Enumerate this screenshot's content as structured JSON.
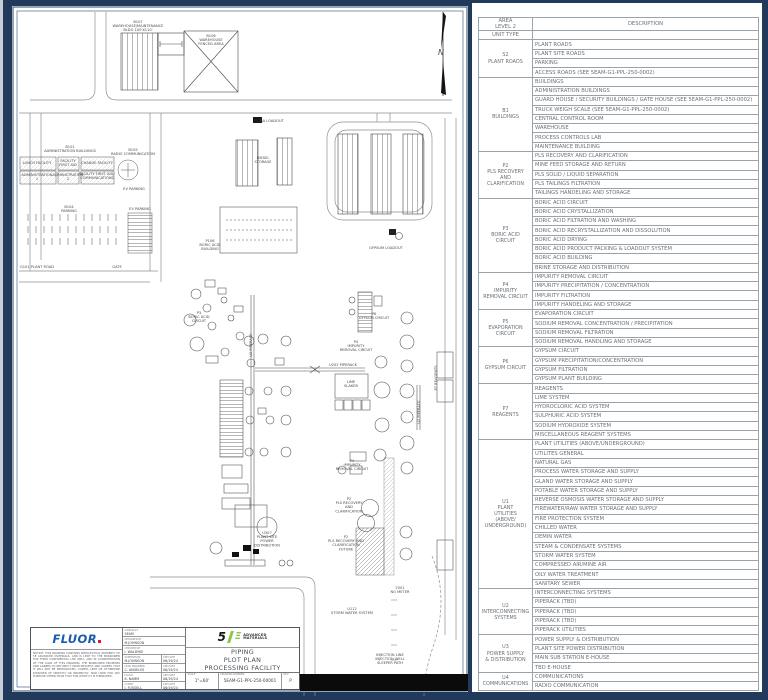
{
  "drawing": {
    "north_label": "N",
    "labels": [
      {
        "x": 138,
        "y": 23,
        "text": "B107\nWAREHOUSE/MAINTENANCE\nBLDG 100'X110'"
      },
      {
        "x": 211,
        "y": 37,
        "text": "B106\nWAREHOUSE\nFENCED AREA"
      },
      {
        "x": 272,
        "y": 122,
        "text": "BA LOADOUT"
      },
      {
        "x": 70,
        "y": 148,
        "text": "B101\nADMINISTRATION BUILDINGS"
      },
      {
        "x": 133,
        "y": 151,
        "text": "B105\nRADIO COMMUNICATION"
      },
      {
        "x": 37,
        "y": 164,
        "text": "LUNCH FACILITY"
      },
      {
        "x": 68,
        "y": 162,
        "text": "FACILITY\nFIRST AID"
      },
      {
        "x": 97,
        "y": 164,
        "text": "CHANGE FACILITY"
      },
      {
        "x": 37,
        "y": 176,
        "text": "ADMINISTRATION\n1"
      },
      {
        "x": 68,
        "y": 176,
        "text": "ADMINISTRATION\n2"
      },
      {
        "x": 97,
        "y": 175,
        "text": "FACILITY FIRST AID/\nCOMMUNICATIONS"
      },
      {
        "x": 134,
        "y": 190,
        "text": "EV PARKING"
      },
      {
        "x": 69,
        "y": 208,
        "text": "B104\nPARKING"
      },
      {
        "x": 140,
        "y": 210,
        "text": "EV PARKING"
      },
      {
        "x": 37,
        "y": 268,
        "text": "G101 PLANT ROAD"
      },
      {
        "x": 117,
        "y": 268,
        "text": "GATE"
      },
      {
        "x": 263,
        "y": 159,
        "text": "DIESEL\nSTORAGE"
      },
      {
        "x": 210,
        "y": 242,
        "text": "P106\nBORIC ACID\nBUILDING"
      },
      {
        "x": 386,
        "y": 249,
        "text": "GYPSUM LOADOUT"
      },
      {
        "x": 199,
        "y": 314,
        "text": "P3\nBORIC ACID\nCIRCUIT"
      },
      {
        "x": 374,
        "y": 315,
        "text": "P6\nGYPSUM CIRCUIT"
      },
      {
        "x": 356,
        "y": 343,
        "text": "P4\nIMPURITY\nREMOVAL CIRCUIT"
      },
      {
        "x": 343,
        "y": 366,
        "text": "U202 PIPERACK"
      },
      {
        "x": 351,
        "y": 383,
        "text": "LIME\nSLAKER"
      },
      {
        "x": 437,
        "y": 378,
        "text": "P7 REAGENTS",
        "vertical": true
      },
      {
        "x": 252,
        "y": 345,
        "text": "U2 PIPERACK",
        "vertical": true
      },
      {
        "x": 420,
        "y": 412,
        "text": "U2 PIPERACK",
        "vertical": true
      },
      {
        "x": 267,
        "y": 534,
        "text": "U307\nPLANT SITE\nPOWER\nDISTRIBUTION"
      },
      {
        "x": 352,
        "y": 462,
        "text": "P4\nIMPURITY\nREMOVAL CIRCUIT"
      },
      {
        "x": 349,
        "y": 500,
        "text": "P2\nPLS RECOVERY\nAND\nCLARIFICATION"
      },
      {
        "x": 346,
        "y": 538,
        "text": "P2\nPLS RECOVERY AND\nCLARIFICATION\nFUTURE"
      },
      {
        "x": 352,
        "y": 610,
        "text": "U112\nSTORM WATER SYSTEM"
      },
      {
        "x": 400,
        "y": 589,
        "text": "2501\nNO METER"
      },
      {
        "x": 390,
        "y": 656,
        "text": "INJECTION LINE\nINJECTION WELL\nSLEEPER PATH"
      }
    ]
  },
  "title_block": {
    "fluor_logo": "FLUOR",
    "notice": "NOTICE: THIS DRAWING CONTAINS INTELLECTUAL PROPERTY OF 5E ADVANCED MATERIALS, AND IS LENT TO THE BORROWER FOR THEIR CONFIDENTIAL USE ONLY, AND IN CONSIDERATION OF THE LOAN OF THIS DRAWING, THE BORROWER PROMISES AND AGREES TO RETURN IT UPON REQUEST AND AGREES THAT IT WILL NOT BE REPRODUCED, COPIED, LENT OR OTHERWISE DISPOSED OF DIRECTLY OR INDIRECTLY, NOR USED FOR ANY PURPOSE OTHER THAN THAT FOR WHICH IT IS FURNISHED.",
    "app_date_label": "APP DATE",
    "approvals": [
      {
        "role": "CONTRACT",
        "name": "5EAM",
        "date": ""
      },
      {
        "role": "DESIGNED BY",
        "name": "M.JOHNSON",
        "date": ""
      },
      {
        "role": "CHECKED BY",
        "name": "J. WALDYKE",
        "date": ""
      },
      {
        "role": "SUPERVISOR",
        "name": "M.JOHNSON",
        "date": "06/19/24"
      },
      {
        "role": "LEAD ENGINEER",
        "name": "C. ANGELES",
        "date": "06/19/24"
      },
      {
        "role": "FLUOR",
        "name": "K. NAMM",
        "date": "06/19/24"
      },
      {
        "role": "CLIENT",
        "name": "J. FUSSELL",
        "date": "06/19/24"
      }
    ],
    "logo_line1": "ADVANCED",
    "logo_line2": "MATERIALS",
    "title_line1": "PIPING",
    "title_line2": "PLOT PLAN",
    "title_line3": "PROCESSING FACILITY",
    "scale_label": "SCALE",
    "scale_value": "1\"=60'",
    "drawing_number_label": "DRAWING NUMBER",
    "drawing_number": "5EAM-G1-PPL-250-00001",
    "rev_label": "REV",
    "rev_value": "P"
  },
  "legend_table": {
    "header": {
      "area_line1": "AREA",
      "area_line2": "LEVEL 2",
      "unit_type": "UNIT TYPE",
      "description": "DESCRIPTION"
    },
    "groups": [
      {
        "unit": "S2\nPLANT ROADS",
        "rows": [
          "PLANT ROADS",
          "PLANT SITE ROADS",
          "PARKING",
          "ACCESS ROADS (SEE 5EAM-G1-PPL-250-0002)"
        ]
      },
      {
        "unit": "B1\nBUILDINGS",
        "rows": [
          "BUILDINGS",
          "ADMINISTRATION BUILDINGS",
          "GUARD HOUSE / SECURITY BUILDINGS / GATE HOUSE (SEE 5EAM-G1-PPL-250-0002)",
          "TRUCK WEIGH SCALE (SEE 5EAM-G1-PPL-250-0002)",
          "CENTRAL CONTROL ROOM",
          "WAREHOUSE",
          "PROCESS CONTROLS LAB",
          "MAINTENANCE BUILDING"
        ]
      },
      {
        "unit": "P2\nPLS RECOVERY\nAND\nCLARIFICATION",
        "rows": [
          "PLS RECOVERY AND CLARIFICATION",
          "MINE FEED STORAGE AND RETURN",
          "PLS SOLID / LIQUID SEPARATION",
          "PLS TAILINGS FILTRATION",
          "TAILINGS HANDELING AND STORAGE"
        ]
      },
      {
        "unit": "P3\nBORIC ACID\nCIRCUIT",
        "rows": [
          "BORIC ACID CIRCUIT",
          "BORIC ACID CRYSTALLIZATION",
          "BORIC ACID FILTRATION AND WASHING",
          "BORIC ACID RECRYSTALLIZATION AND DISSOLUTION",
          "BORIC ACID DRYING",
          "BORIC ACID PRODUCT PACKING & LOADOUT SYSTEM",
          "BORIC ACID BUILDING",
          "BRINE STORAGE AND DISTRIBUTION"
        ]
      },
      {
        "unit": "P4\nIMPURITY\nREMOVAL CIRCUIT",
        "rows": [
          "IMPURITY REMOVAL CIRCUIT",
          "IMPURITY PRECIPITATION / CONCENTRATION",
          "IMPURITY FILTRATION",
          "IMPURITY HANDELING AND STORAGE"
        ]
      },
      {
        "unit": "P5\nEVAPORATION\nCIRCUIT",
        "rows": [
          "EVAPORATION CIRCUIT",
          "SODIUM REMOVAL CONCENTRATION / PRECIPITATION",
          "SODIUM REMOVAL FILTRATION",
          "SODIUM REMOVAL HANDLING AND STORAGE"
        ]
      },
      {
        "unit": "P6\nGYPSUM CIRCUIT",
        "rows": [
          "GYPSUM CIRCUIT",
          "GYPSUM PRECIPITATION/CONCENTRATION",
          "GYPSUM FILTRATION",
          "GYPSUM PLANT BUILDING"
        ]
      },
      {
        "unit": "P7\nREAGENTS",
        "rows": [
          "REAGENTS",
          "LIME SYSTEM",
          "HYDROCLORIC ACID SYSTEM",
          "SULPHURIC ACID SYSTEM",
          "SODIUM HYDROXIDE SYSTEM",
          "MISCELLANEOUS REAGENT SYSTEMS"
        ]
      },
      {
        "unit": "U1\nPLANT\nUTILITIES\n(ABOVE/\nUNDERGROUND)",
        "rows": [
          "PLANT UTILITIES (ABOVE/UNDERGROUND)",
          "UTILITES GENERAL",
          "NATURAL GAS",
          "PROCESS WATER STORAGE AND SUPPLY",
          "GLAND WATER STORAGE AND SUPPLY",
          "POTABLE WATER STORAGE AND SUPPLY",
          "REVERSE OSMOSIS WATER STORAGE AND SUPPLY",
          "FIREWATER/RAW WATER STORAGE AND SUPPLY",
          "FIRE PROTECTION SYSTEM",
          "CHILLED WATER",
          "DEMIN WATER",
          "STEAM & CONDENSATE SYSTEMS",
          "STORM WATER SYSTEM",
          "COMPRESSED AIR/MINE AIR",
          "OILY WATER TREATMENT",
          "SANITARY SEWER"
        ]
      },
      {
        "unit": "U2\nINTERCONNECTING\nSYSTEMS",
        "rows": [
          "INTERCONNECTING SYSTEMS",
          "PIPERACK (TBD)",
          "PIPERACK (TBD)",
          "PIPERACK (TBD)",
          "PIPERACK UTILITIES"
        ]
      },
      {
        "unit": "U3\nPOWER SUPPLY\n& DISTRIBUTION",
        "rows": [
          "POWER SUPPLY & DISTRIBUTION",
          "PLANT SITE POWER DISTRIBUTION",
          "MAIN SUB STATION E-HOUSE",
          "TBD E-HOUSE"
        ]
      },
      {
        "unit": "U4\nCOMMUNICATIONS",
        "rows": [
          "COMMUNICATIONS",
          "RADIO COMMUNICATION"
        ]
      }
    ]
  }
}
